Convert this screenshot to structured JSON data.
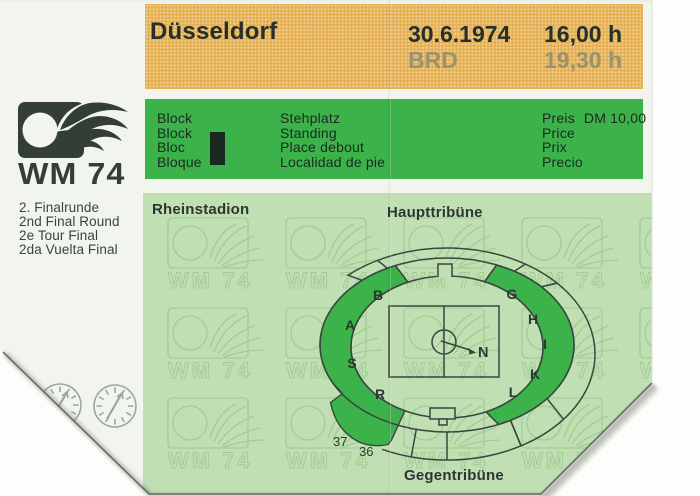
{
  "ticket": {
    "header": {
      "city": "Düsseldorf",
      "date": "30.6.1974",
      "session1_time": "16,00 h",
      "team": "BRD",
      "session2_time": "19,30 h"
    },
    "block": {
      "labels": [
        "Block",
        "Block",
        "Bloc",
        "Bloque"
      ],
      "value": "I"
    },
    "seating": {
      "labels": [
        "Stehplatz",
        "Standing",
        "Place debout",
        "Localidad de pie"
      ]
    },
    "price": {
      "labels": [
        "Preis",
        "Price",
        "Prix",
        "Precio"
      ],
      "value": "DM 10,00"
    },
    "brand": {
      "logo_text": "WM 74",
      "round_labels": [
        "2. Finalrunde",
        "2nd Final Round",
        "2e Tour Final",
        "2da Vuelta Final"
      ]
    },
    "stadium": {
      "name": "Rheinstadion",
      "stand_top": "Haupttribüne",
      "stand_bottom": "Gegentribüne",
      "sections": [
        "B",
        "G",
        "A",
        "H",
        "I",
        "S",
        "K",
        "R",
        "L"
      ],
      "compass": "N",
      "gates": [
        "37",
        "36"
      ]
    },
    "colors": {
      "band_orange": "#e6b052",
      "band_green": "#3cb34a",
      "panel_green": "#c0e0b4",
      "highlight_green": "#3cb34a",
      "ink": "#262f29",
      "faded_ink": "#9a9170",
      "diagram_line": "#39463e"
    }
  }
}
